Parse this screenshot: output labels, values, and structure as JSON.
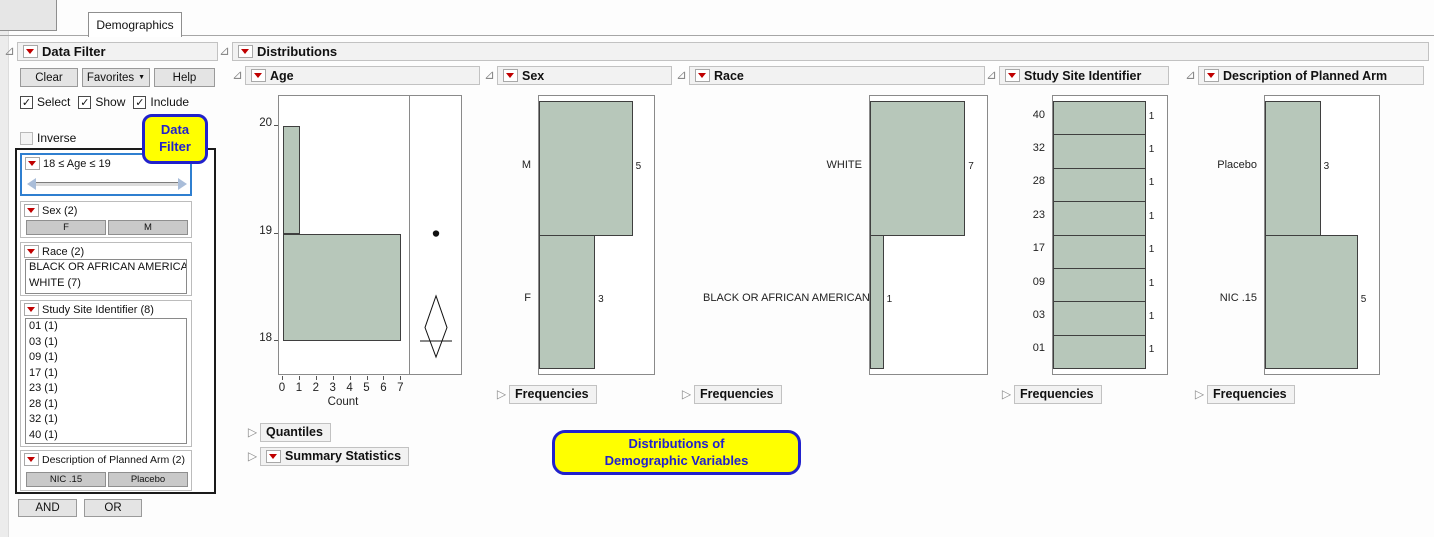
{
  "window": {
    "tab_label": "Demographics"
  },
  "data_filter": {
    "title": "Data Filter",
    "clear_button": "Clear",
    "favorites_button": "Favorites",
    "help_button": "Help",
    "select_label": "Select",
    "show_label": "Show",
    "include_label": "Include",
    "inverse_label": "Inverse",
    "callout_line1": "Data",
    "callout_line2": "Filter",
    "age_filter_label": "18 ≤ Age ≤ 19",
    "sex_filter": {
      "label": "Sex (2)",
      "button_f": "F",
      "button_m": "M"
    },
    "race_filter": {
      "label": "Race (2)",
      "items": [
        "BLACK OR AFRICAN AMERICAN (1)",
        "WHITE (7)"
      ]
    },
    "site_filter": {
      "label": "Study Site Identifier (8)",
      "items": [
        "01 (1)",
        "03 (1)",
        "09 (1)",
        "17 (1)",
        "23 (1)",
        "28 (1)",
        "32 (1)",
        "40 (1)"
      ]
    },
    "arm_filter": {
      "label": "Description of Planned Arm (2)",
      "button_nic": "NIC .15",
      "button_placebo": "Placebo"
    },
    "and_button": "AND",
    "or_button": "OR"
  },
  "distributions": {
    "title": "Distributions",
    "quantiles_label": "Quantiles",
    "summary_statistics_label": "Summary Statistics",
    "frequencies_label": "Frequencies",
    "callout_line1": "Distributions of",
    "callout_line2": "Demographic Variables"
  },
  "chart_data": [
    {
      "type": "bar",
      "subtype": "horizontal-histogram",
      "title": "Age",
      "bins": [
        {
          "low": 18,
          "high": 19,
          "count": 7
        },
        {
          "low": 19,
          "high": 20,
          "count": 1
        }
      ],
      "y_ticks": [
        18,
        19,
        20
      ],
      "x_ticks": [
        0,
        1,
        2,
        3,
        4,
        5,
        6,
        7
      ],
      "xlabel": "Count",
      "y_range": [
        17.674,
        20.28
      ],
      "boxplot": {
        "outlier": 19,
        "mean": 18.125,
        "ci_low": 17.85,
        "ci_high": 18.42,
        "median": 18
      }
    },
    {
      "type": "bar",
      "title": "Sex",
      "categories": [
        "M",
        "F"
      ],
      "values": [
        5,
        3
      ]
    },
    {
      "type": "bar",
      "title": "Race",
      "categories": [
        "WHITE",
        "BLACK OR AFRICAN AMERICAN"
      ],
      "values": [
        7,
        1
      ]
    },
    {
      "type": "bar",
      "title": "Study Site Identifier",
      "categories": [
        "40",
        "32",
        "28",
        "23",
        "17",
        "09",
        "03",
        "01"
      ],
      "values": [
        1,
        1,
        1,
        1,
        1,
        1,
        1,
        1
      ]
    },
    {
      "type": "bar",
      "title": "Description of Planned Arm",
      "categories": [
        "Placebo",
        "NIC .15"
      ],
      "values": [
        3,
        5
      ]
    }
  ],
  "colors": {
    "bar_fill": "#b7c7ba",
    "bar_border": "#3f3f3f",
    "callout_bg": "#ffff00",
    "callout_accent": "#2121cc",
    "red_triangle": "#c00000",
    "selected_filter_border": "#2f7fd0"
  }
}
